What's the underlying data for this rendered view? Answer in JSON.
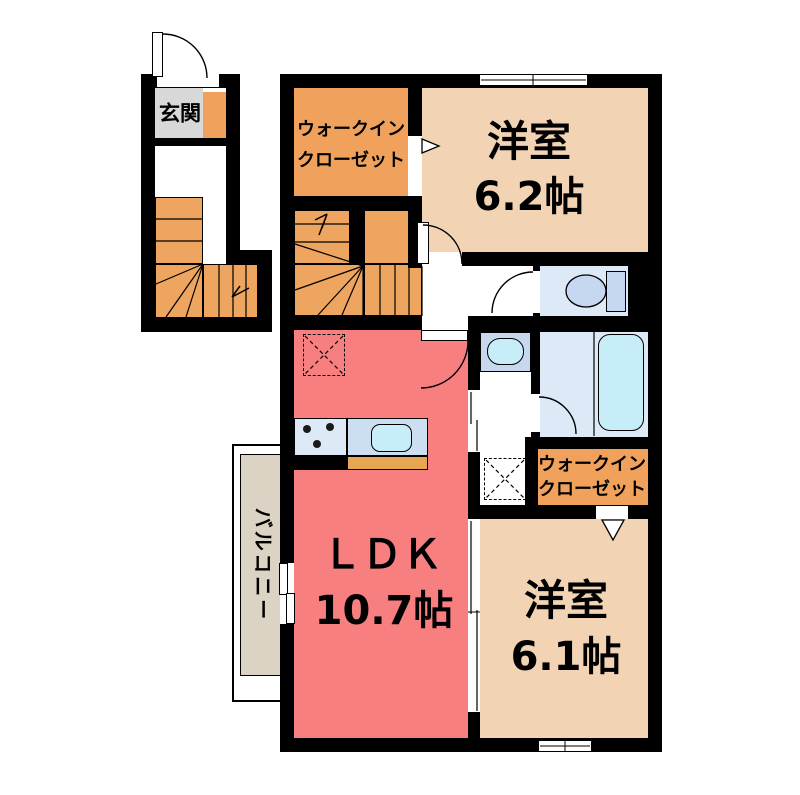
{
  "colors": {
    "wall": "#000000",
    "bedroom_floor": "#f2d3b4",
    "closet_floor": "#f0a25c",
    "stairs_floor": "#eda55f",
    "ldk_floor": "#f87f7f",
    "balcony_floor": "#dbd3c4",
    "entrance_floor": "#d8d8d8",
    "wet_room_floor": "#dde9f6",
    "counter_blue": "#c5d8f0",
    "kitchen_counter_blue": "#ccdef2",
    "water_fixture": "#c6edf8",
    "kitchen_counter_edge": "#e8a653"
  },
  "rooms": {
    "entrance": {
      "label": "玄関"
    },
    "closet_top": {
      "line1": "ウォークイン",
      "line2": "クローゼット"
    },
    "bedroom_top": {
      "name": "洋室",
      "size": "6.2帖"
    },
    "ldk": {
      "name": "ＬＤＫ",
      "size": "10.7帖"
    },
    "bedroom_bottom": {
      "name": "洋室",
      "size": "6.1帖"
    },
    "closet_bottom": {
      "line1": "ウォークイン",
      "line2": "クローゼット"
    },
    "balcony": {
      "label": "バルコニー"
    }
  }
}
